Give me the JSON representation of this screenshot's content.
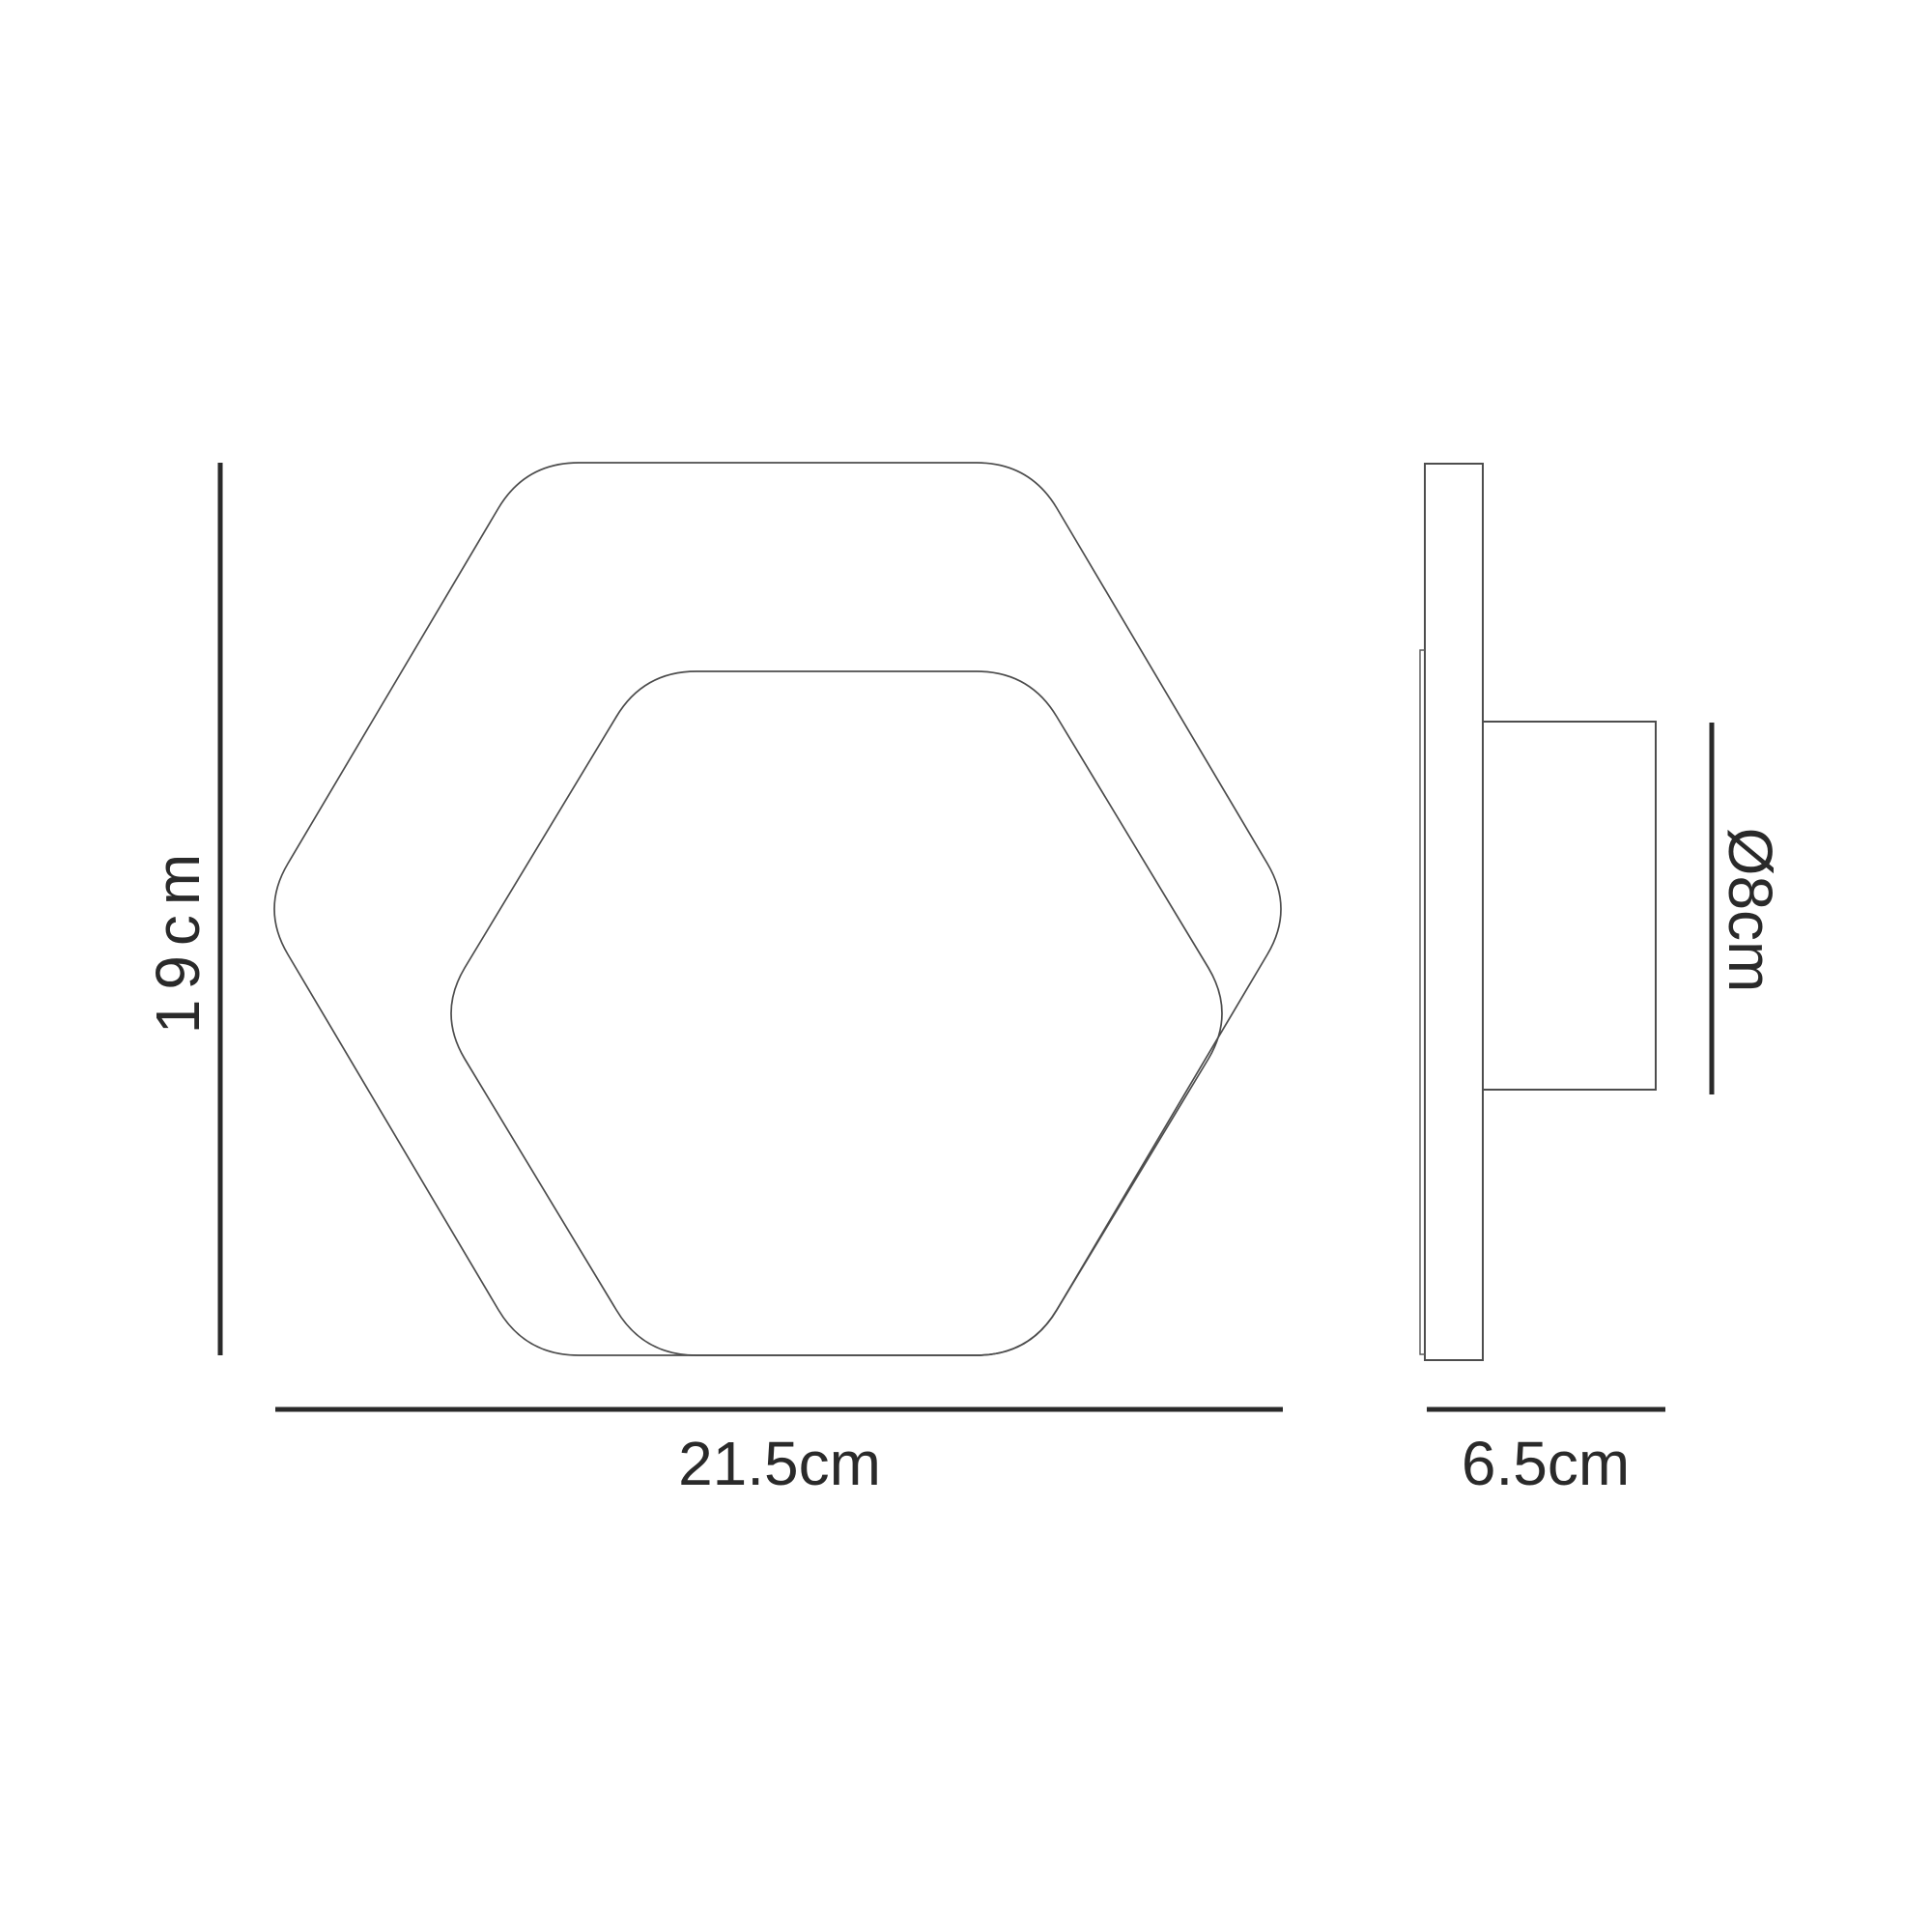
{
  "diagram": {
    "type": "technical-dimension-drawing",
    "subject": "hexagonal wall light fixture, front elevation and side elevation",
    "colors": {
      "background": "#ffffff",
      "outline": "#4d4d4d",
      "thin_edge": "#5a5a5a",
      "dimension": "#2a2a2a"
    },
    "front_view": {
      "shapes": [
        "outer-rounded-hexagon",
        "inner-rounded-hexagon-offset-to-bottom-right"
      ],
      "dimensions": {
        "height": {
          "label": "19cm",
          "orientation": "vertical",
          "position": "left-of-front-view"
        },
        "width": {
          "label": "21.5cm",
          "orientation": "horizontal",
          "position": "below-front-view"
        }
      }
    },
    "side_view": {
      "shapes": [
        "back-plate-edge",
        "inner-panel-edge",
        "mounting-box"
      ],
      "dimensions": {
        "depth": {
          "label": "6.5cm",
          "orientation": "horizontal",
          "position": "below-side-view"
        },
        "mount_diameter": {
          "label": "Ø8cm",
          "orientation": "vertical-rotated",
          "position": "right-of-side-view"
        }
      }
    }
  }
}
